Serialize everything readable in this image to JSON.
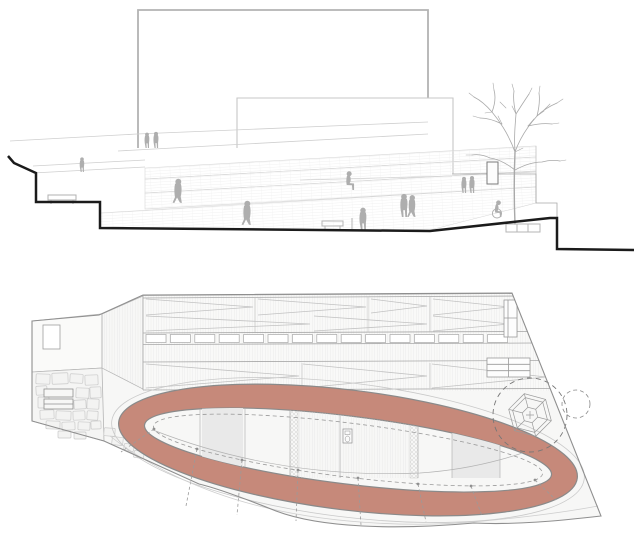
{
  "colors": {
    "canvas_bg": "#ffffff",
    "track_fill": "#c6897a",
    "track_edge": "#8a8a8a",
    "ground_line": "#1b1b1b",
    "building_line": "#b3b3b3",
    "light_line": "#cfcfcf",
    "detail_line": "#a8a8a8",
    "figure_fill": "#aeaeae",
    "site_fill": "#f7f7f6",
    "panel_shade": "#e9e9e9",
    "tree_line": "#a9a9a9"
  }
}
